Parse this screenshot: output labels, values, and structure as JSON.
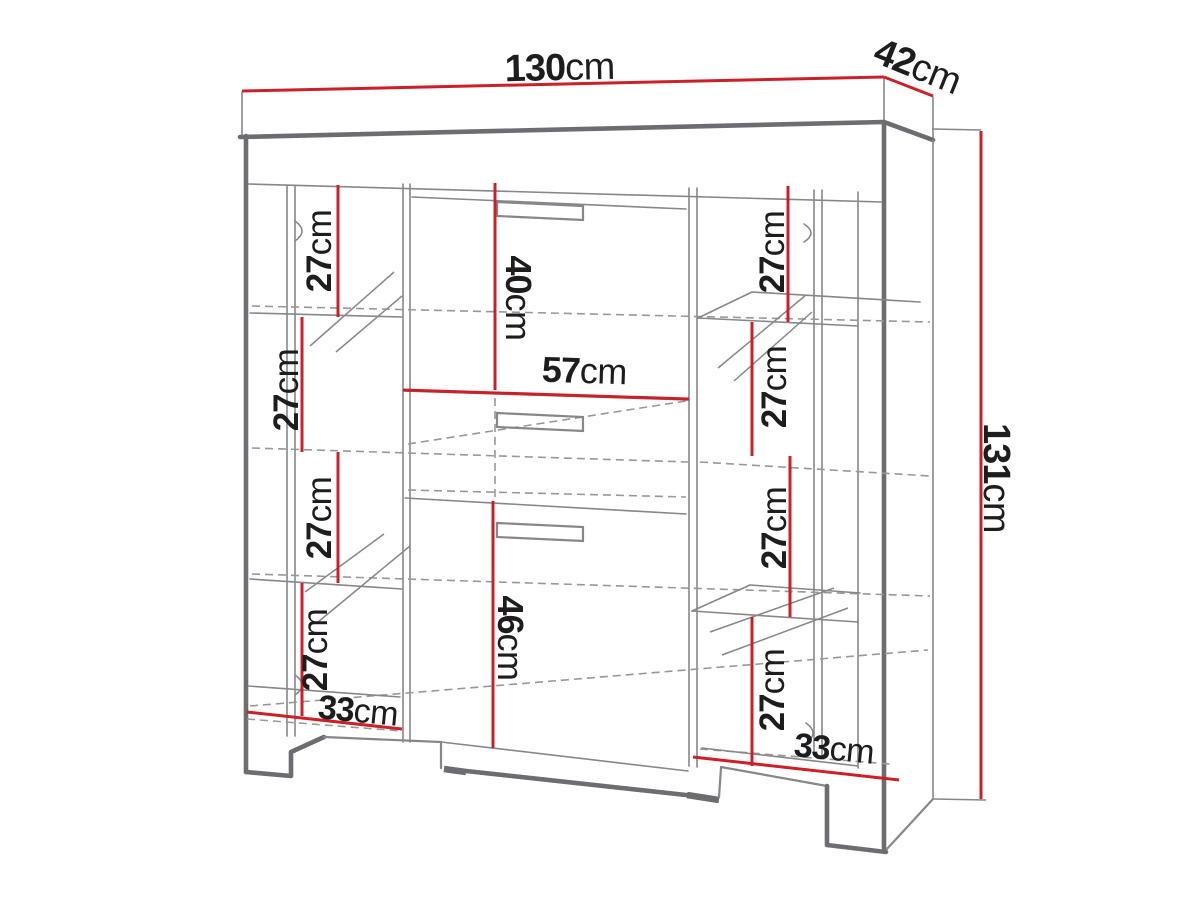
{
  "diagram_type": "furniture-dimension-drawing",
  "colors": {
    "dimension_red": "#cb2027",
    "outline_dark": "#6b6d70",
    "line_grey": "#85878a",
    "dash_grey": "#96989b",
    "text": "#1d1d1f"
  },
  "dims": {
    "width": {
      "num": "130",
      "unit": "cm"
    },
    "depth": {
      "num": "42",
      "unit": "cm"
    },
    "height": {
      "num": "131",
      "unit": "cm"
    },
    "top_door": {
      "num": "40",
      "unit": "cm"
    },
    "middle_width": {
      "num": "57",
      "unit": "cm"
    },
    "bottom_door": {
      "num": "46",
      "unit": "cm"
    },
    "left_shelf_1": {
      "num": "27",
      "unit": "cm"
    },
    "left_shelf_2": {
      "num": "27",
      "unit": "cm"
    },
    "left_shelf_3": {
      "num": "27",
      "unit": "cm"
    },
    "left_shelf_4": {
      "num": "27",
      "unit": "cm"
    },
    "right_shelf_1": {
      "num": "27",
      "unit": "cm"
    },
    "right_shelf_2": {
      "num": "27",
      "unit": "cm"
    },
    "right_shelf_3": {
      "num": "27",
      "unit": "cm"
    },
    "right_shelf_4": {
      "num": "27",
      "unit": "cm"
    },
    "left_base_depth": {
      "num": "33",
      "unit": "cm"
    },
    "right_base_depth": {
      "num": "33",
      "unit": "cm"
    }
  }
}
